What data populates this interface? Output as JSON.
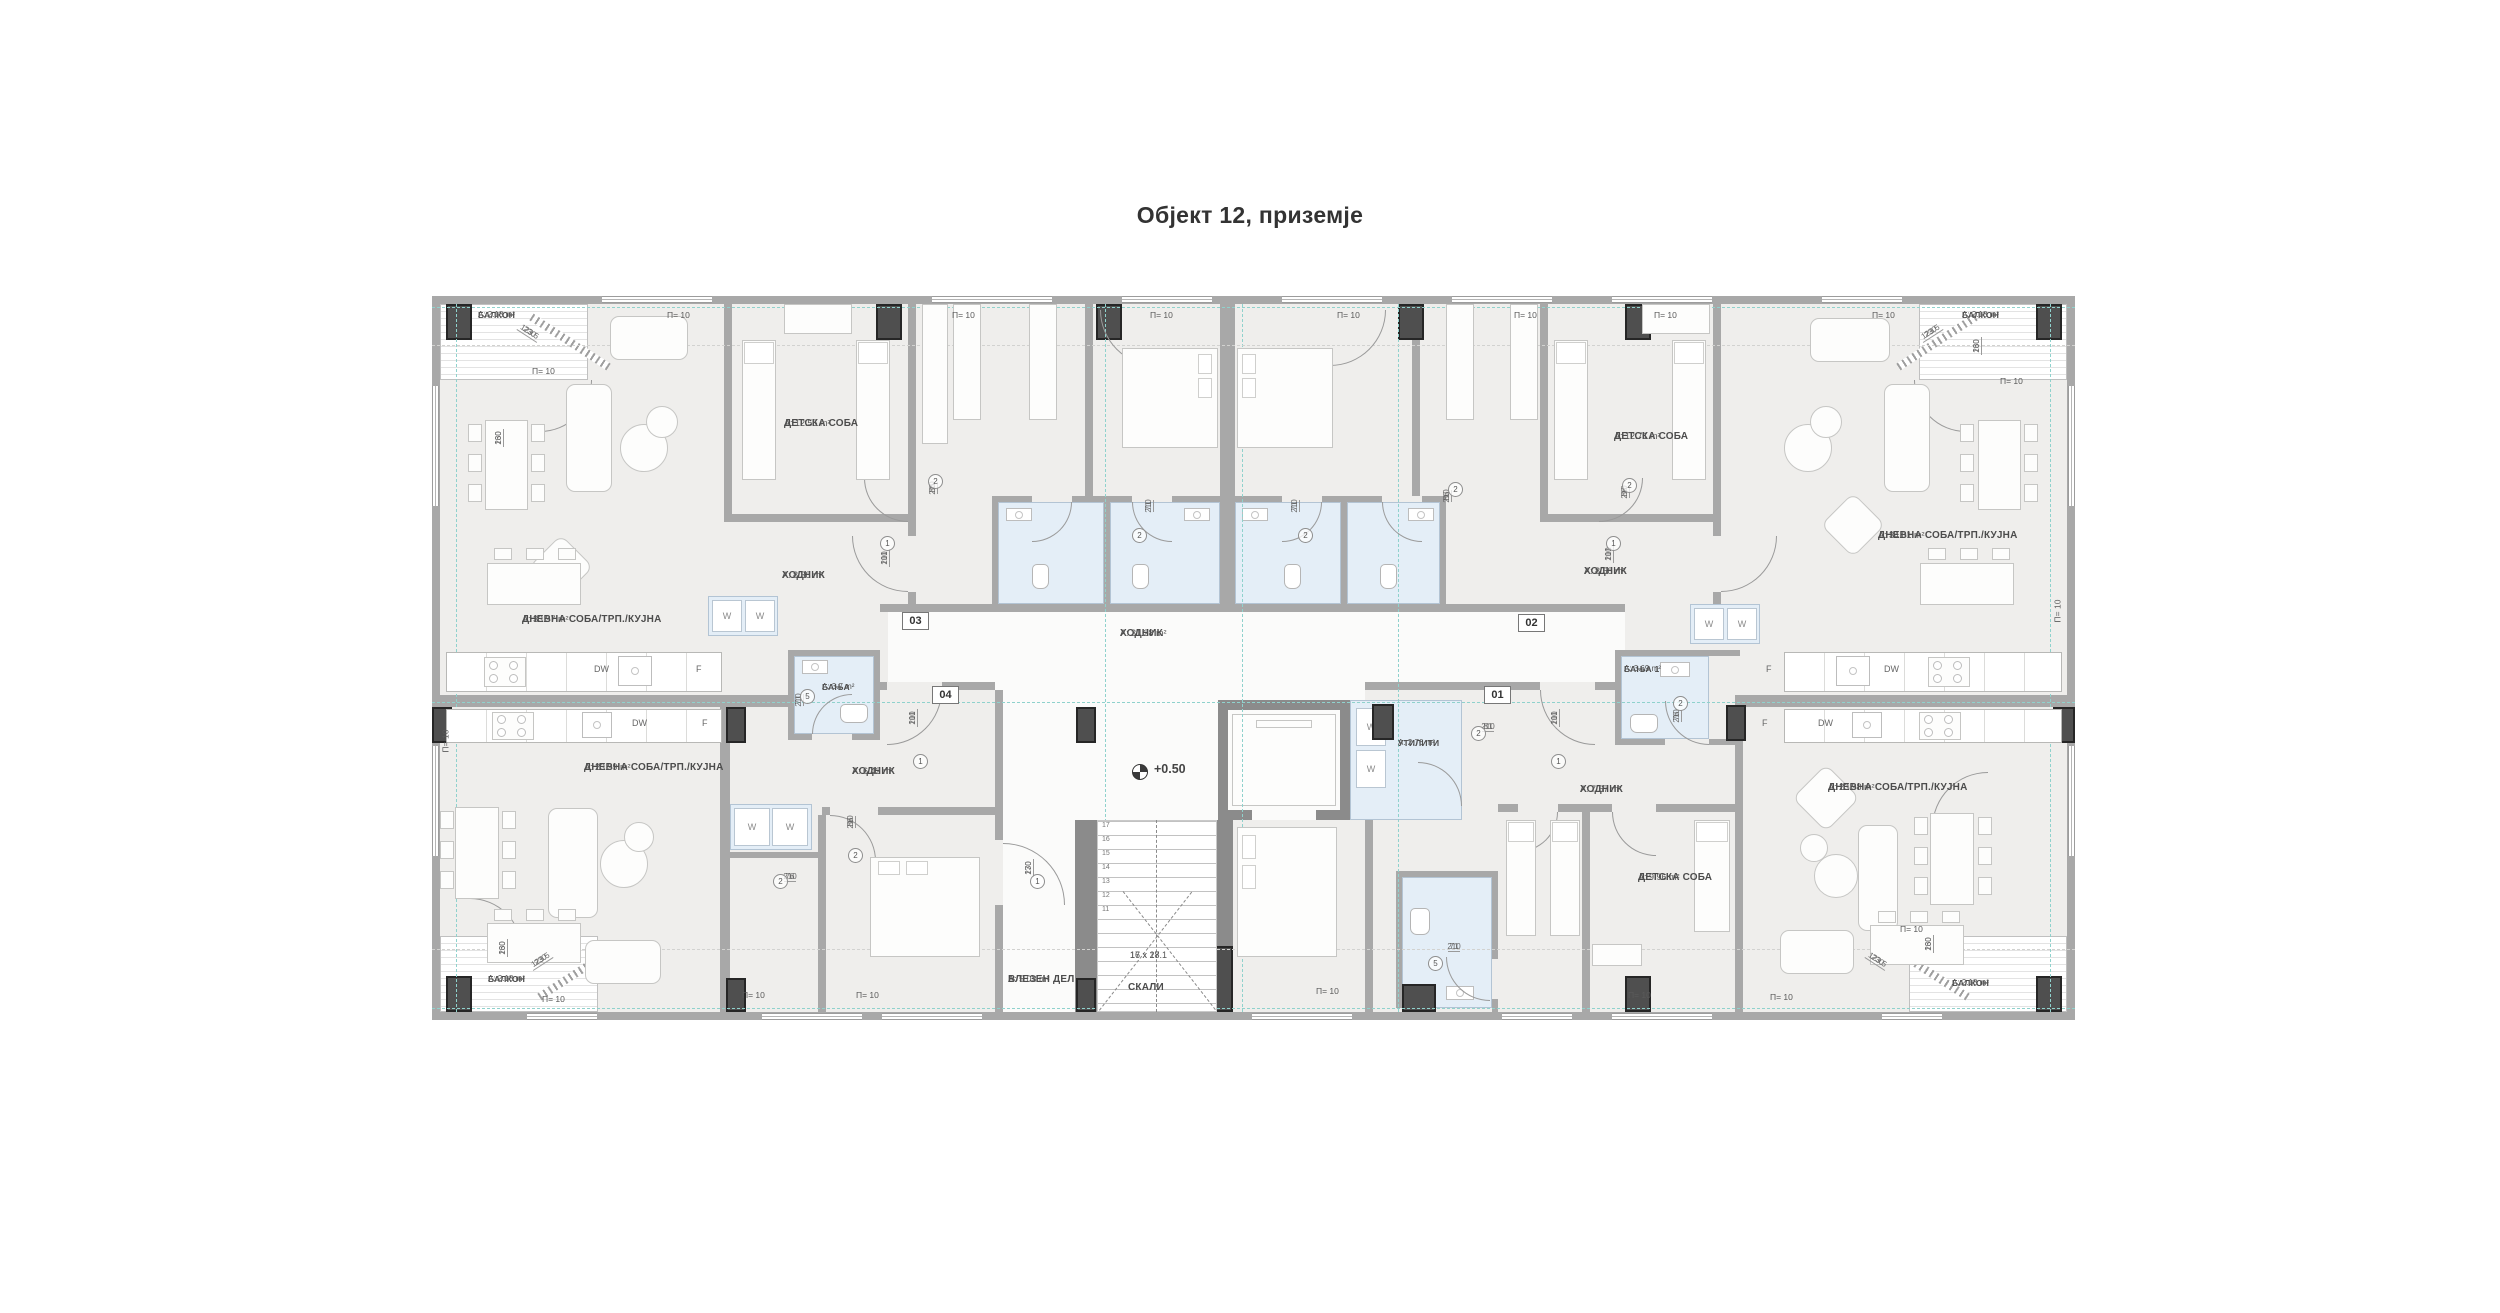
{
  "title": "Објект 12, приземје",
  "legend": {
    "p10": "П= 10",
    "dw": "DW",
    "f": "F",
    "w": "W"
  },
  "elevation": "+0.50",
  "units": {
    "u01": "01",
    "u02": "02",
    "u03": "03",
    "u04": "04"
  },
  "rooms": {
    "apt03_living": {
      "name": "ДНЕВНА СОБА/ТРП./КУЈНА",
      "area": "А: 33.97 m²"
    },
    "apt03_children": {
      "name": "ДЕТСКА СОБА",
      "area": "А: 12.55 m²"
    },
    "apt03_hall": {
      "name": "ХОДНИК",
      "area": "А: 8.38 m²"
    },
    "apt03_balcony": {
      "name": "БАЛКОН",
      "area": "А: 2.18 m²"
    },
    "apt02_living": {
      "name": "ДНЕВНА СОБА/ТРП./КУЈНА",
      "area": "А: 34.01 m²"
    },
    "apt02_children": {
      "name": "ДЕТСКА СОБА",
      "area": "А: 12.71 m²"
    },
    "apt02_hall": {
      "name": "ХОДНИК",
      "area": "А: 8.58 m²"
    },
    "apt02_balcony": {
      "name": "БАЛКОН",
      "area": "А: 2.18 m²"
    },
    "apt04_living": {
      "name": "ДНЕВНА СОБА/ТРП./КУЈНА",
      "area": "А: 23.99 m²"
    },
    "apt04_bath": {
      "name": "БАЊА",
      "area": "А: 3.7 m²"
    },
    "apt04_hall": {
      "name": "ХОДНИК",
      "area": "А: 6.42 m²"
    },
    "apt04_balcony": {
      "name": "БАЛКОН",
      "area": "А: 2.18 m²"
    },
    "apt01_living": {
      "name": "ДНЕВНА СОБА/ТРП./КУЈНА",
      "area": "А: 23.98 m²"
    },
    "apt01_bath": {
      "name": "БАЊА 1",
      "area": "А: 3.69 m²"
    },
    "apt01_hall": {
      "name": "ХОДНИК",
      "area": "А: 7.67 m²"
    },
    "apt01_children": {
      "name": "ДЕТСКА СОБА",
      "area": "А: 9.96 m²"
    },
    "apt01_balcony": {
      "name": "БАЛКОН",
      "area": "А: 2.18 m²"
    },
    "utility": {
      "name": "УТИЛИТИ",
      "area": "А: 2.76 m²"
    },
    "entry_hall": {
      "name": "ВЛЕЗЕН ДЕЛ",
      "area": "А: 5.03 m²"
    },
    "main_corridor": {
      "name": "ХОДНИК",
      "area": "А: 31.28 m²"
    },
    "stairs": {
      "name": "СКАЛИ",
      "steps_line1": "17 x 17.1",
      "steps_line2": "16 x 28"
    }
  },
  "dims": {
    "d86": "86",
    "d101": "101",
    "d71": "71",
    "d76": "76",
    "d81": "81",
    "d170": "170",
    "d210": "210",
    "d230": "230",
    "d123": "123.5",
    "d160": "160"
  },
  "door_tags": {
    "n1": "1",
    "n2": "2",
    "n5": "5"
  },
  "stair_numbers": [
    "17",
    "16",
    "15",
    "14",
    "13",
    "12",
    "11"
  ]
}
